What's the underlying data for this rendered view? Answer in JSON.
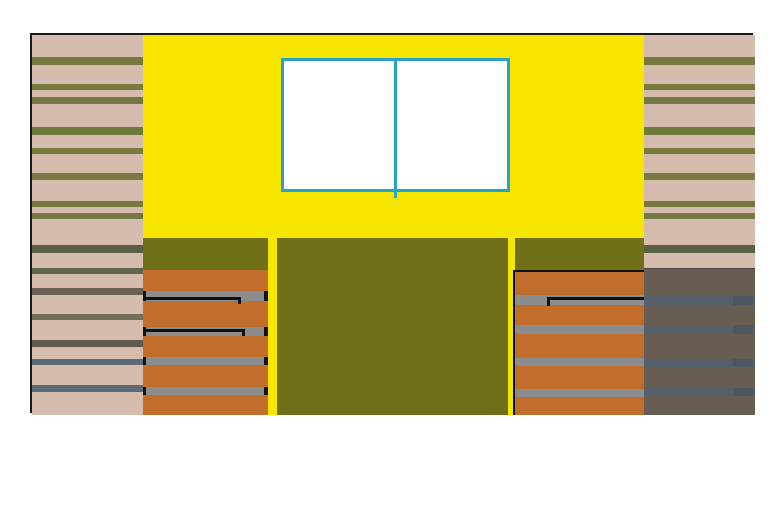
{
  "scene": {
    "kind": "building-facade-elevation-drawing",
    "canvas": {
      "w": 773,
      "h": 508,
      "background": "#ffffff"
    }
  },
  "palette": {
    "outline": "#1a1a1a",
    "black": "#111111",
    "white": "#ffffff",
    "yellow_wall": "#f7e600",
    "tan_siding": "#d5bcae",
    "olive_stripe": "#78793f",
    "olive_panel": "#6f7019",
    "orange_panel": "#c16d2b",
    "gray_slat": "#8b8c8e",
    "taupe_shadow": "#675d52",
    "shadow_slat": "#556069",
    "shadow_slat_dark": "#4d5761",
    "cyan_window": "#26a5cb"
  },
  "frame": {
    "x": 30,
    "y": 33,
    "w": 723,
    "h": 380,
    "border_px": 2
  },
  "left_siding": {
    "x": 0,
    "y": 0,
    "w": 111,
    "h": 380,
    "bg": "#d5bcae",
    "stripes": [
      {
        "top": 22,
        "h": 8,
        "color": "#78793f"
      },
      {
        "top": 49,
        "h": 6,
        "color": "#78793f"
      },
      {
        "top": 62,
        "h": 7,
        "color": "#747840"
      },
      {
        "top": 92,
        "h": 8,
        "color": "#6e7a3c"
      },
      {
        "top": 113,
        "h": 6,
        "color": "#78793f"
      },
      {
        "top": 138,
        "h": 7,
        "color": "#777a41"
      },
      {
        "top": 166,
        "h": 6,
        "color": "#78793f"
      },
      {
        "top": 178,
        "h": 6,
        "color": "#747841"
      },
      {
        "top": 210,
        "h": 8,
        "color": "#5a6044"
      },
      {
        "top": 233,
        "h": 6,
        "color": "#60654e"
      },
      {
        "top": 253,
        "h": 7,
        "color": "#6a6054"
      },
      {
        "top": 279,
        "h": 6,
        "color": "#6f6e59"
      },
      {
        "top": 305,
        "h": 7,
        "color": "#63594d"
      },
      {
        "top": 324,
        "h": 6,
        "color": "#5d6b76"
      },
      {
        "top": 350,
        "h": 7,
        "color": "#5d6b76"
      }
    ]
  },
  "right_siding": {
    "x": 612,
    "y": 0,
    "w": 111,
    "h": 380,
    "bg": "#d5bcae",
    "stripes": [
      {
        "top": 22,
        "h": 8,
        "color": "#78793f"
      },
      {
        "top": 49,
        "h": 6,
        "color": "#78793f"
      },
      {
        "top": 62,
        "h": 7,
        "color": "#747840"
      },
      {
        "top": 92,
        "h": 8,
        "color": "#6e7a3c"
      },
      {
        "top": 113,
        "h": 6,
        "color": "#78793f"
      },
      {
        "top": 138,
        "h": 7,
        "color": "#777a41"
      },
      {
        "top": 166,
        "h": 6,
        "color": "#78793f"
      },
      {
        "top": 178,
        "h": 6,
        "color": "#747841"
      },
      {
        "top": 210,
        "h": 8,
        "color": "#5a6044"
      }
    ]
  },
  "yellow_wall": {
    "x": 111,
    "y": 0,
    "w": 501,
    "h": 380,
    "bg": "#f7e600"
  },
  "window": {
    "x": 249,
    "y": 23,
    "w": 229,
    "h": 134,
    "fill": "#ffffff",
    "frame_color": "#26a5cb",
    "frame_px": 3,
    "mullion": {
      "left": 110,
      "w": 3,
      "h": 137
    },
    "pane_count": 2
  },
  "left_panel": {
    "x": 111,
    "y": 203,
    "w": 125,
    "h": 177,
    "band": {
      "top": 0,
      "h": 32,
      "color": "#6f7018"
    },
    "body": {
      "top": 32,
      "h": 145,
      "color": "#c16d2b"
    },
    "slat_color": "#8b8c8e",
    "slats": [
      {
        "top": 53,
        "h": 10
      },
      {
        "top": 89,
        "h": 9
      },
      {
        "top": 119,
        "h": 8
      },
      {
        "top": 149,
        "h": 8
      }
    ],
    "black_lines": [
      {
        "top": 59,
        "h": 3,
        "left": 0,
        "w": 98,
        "tick": {
          "x": 95,
          "top": 59,
          "w": 3,
          "h": 7
        }
      },
      {
        "top": 91,
        "h": 3,
        "left": 0,
        "w": 102,
        "tick": {
          "x": 99,
          "top": 91,
          "w": 3,
          "h": 7
        }
      }
    ],
    "edge_ticks": {
      "right": {
        "x": 121,
        "w": 4
      },
      "left": {
        "x": 0,
        "w": 3
      },
      "tops": [
        [
          53,
          10
        ],
        [
          89,
          9
        ],
        [
          119,
          8
        ],
        [
          149,
          8
        ]
      ]
    }
  },
  "center_panel": {
    "x": 245,
    "y": 203,
    "w": 231,
    "h": 177,
    "bg": "#6f7019"
  },
  "right_panel": {
    "x": 481,
    "y": 203,
    "w": 131,
    "h": 177,
    "band": {
      "left": 2,
      "top": 0,
      "w": 129,
      "h": 32,
      "color": "#6f7018"
    },
    "body": {
      "left": 2,
      "top": 34,
      "w": 129,
      "h": 143,
      "color": "#c16d2b"
    },
    "outline": {
      "top": {
        "x": 0,
        "y": 32,
        "w": 131,
        "h": 2
      },
      "left": {
        "x": 0,
        "y": 32,
        "w": 2,
        "h": 145
      }
    },
    "slat_color": "#8b8c8e",
    "slats": [
      {
        "top": 57,
        "h": 10
      },
      {
        "top": 87,
        "h": 9
      },
      {
        "top": 120,
        "h": 8
      },
      {
        "top": 151,
        "h": 8
      }
    ],
    "black_lines": [
      {
        "top": 59,
        "h": 3,
        "left": 34,
        "w": 97,
        "tick": {
          "x": 34,
          "top": 59,
          "w": 3,
          "h": 9
        }
      }
    ]
  },
  "shadow_wall": {
    "x": 612,
    "y": 233,
    "w": 111,
    "h": 147,
    "bg": "#675d52",
    "slat_color": "#556069",
    "cap_color": "#4d5761",
    "cap_w": 20,
    "slats": [
      {
        "top": 28,
        "h": 9
      },
      {
        "top": 57,
        "h": 9
      },
      {
        "top": 91,
        "h": 8
      },
      {
        "top": 120,
        "h": 8
      }
    ]
  }
}
